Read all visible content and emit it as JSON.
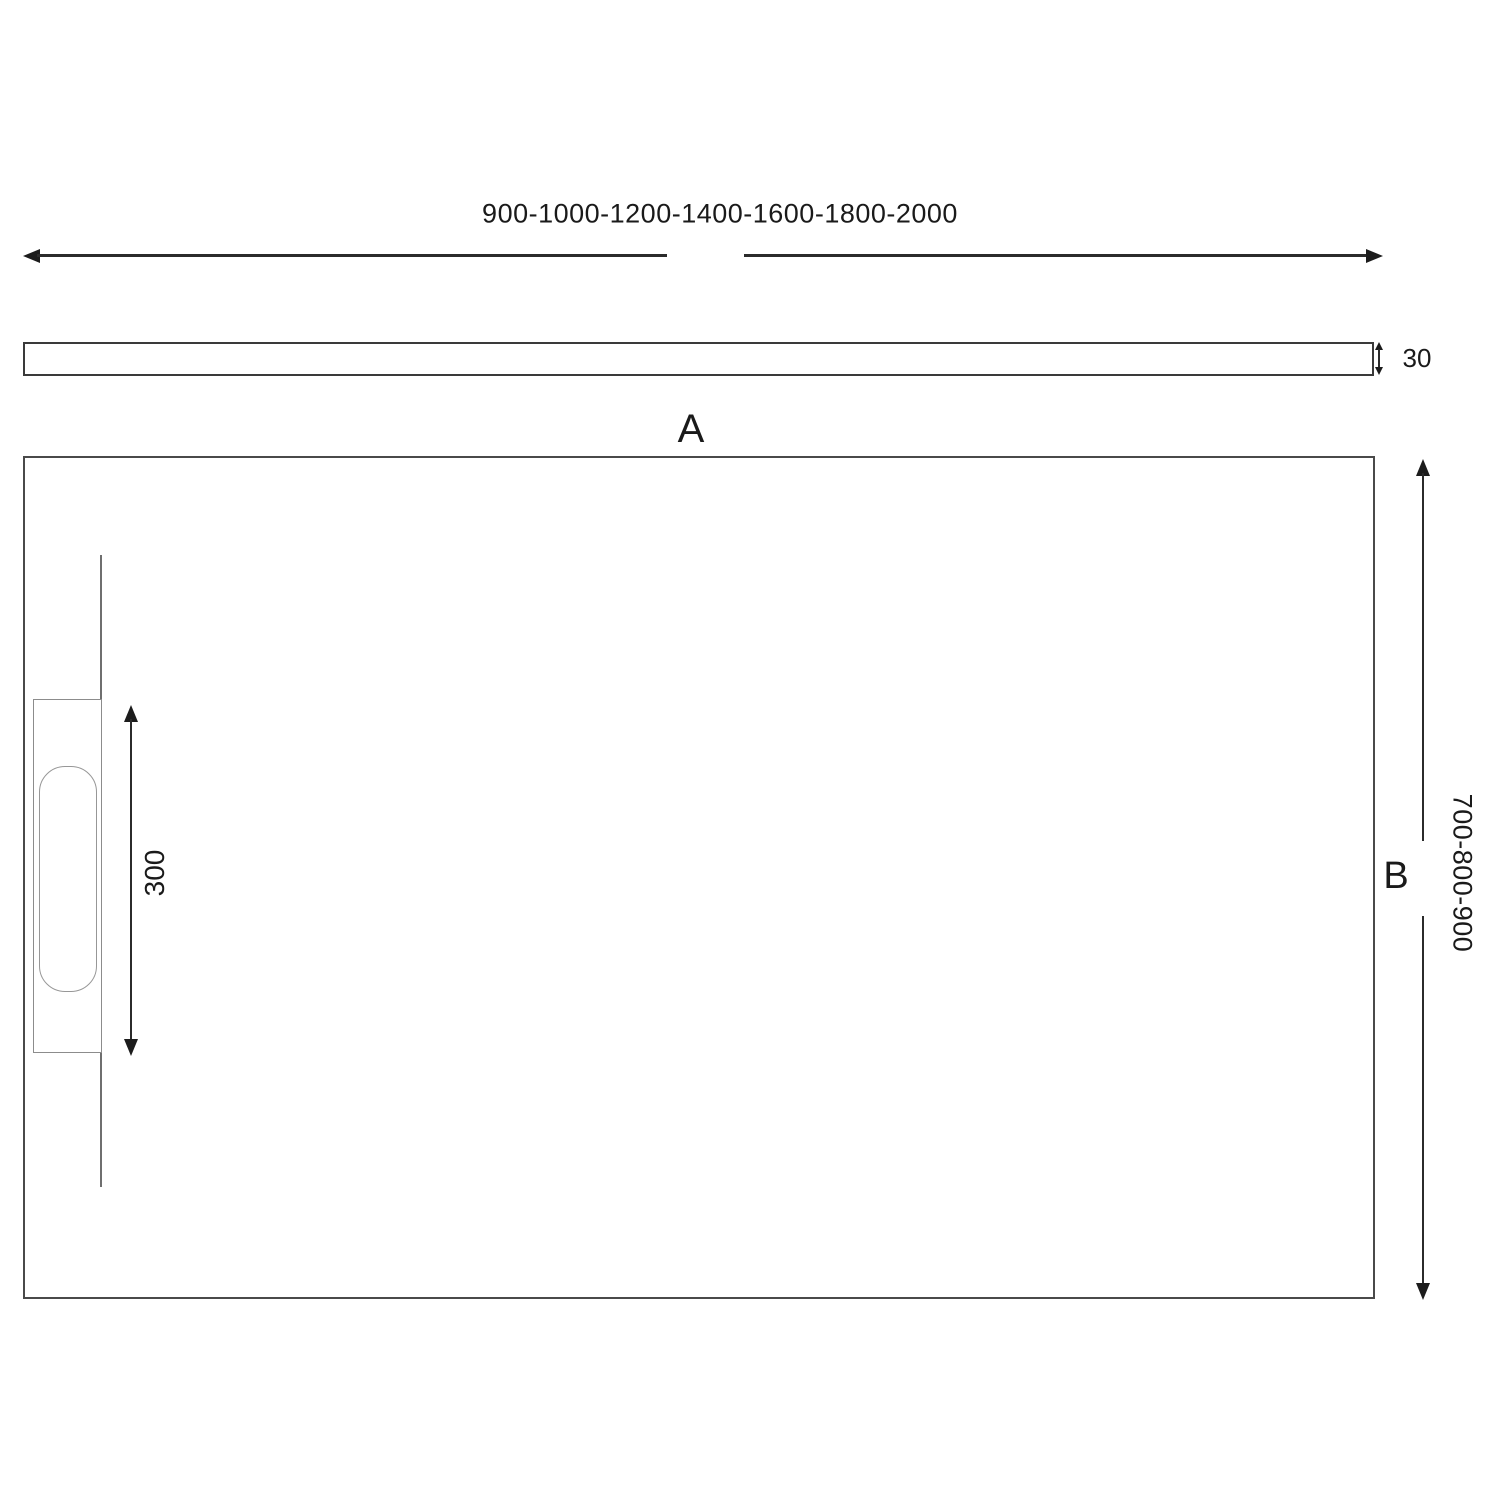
{
  "drawing": {
    "title_hint": "shower tray dimension drawing",
    "width_options_label": "900-1000-1200-1400-1600-1800-2000",
    "thickness_label": "30",
    "width_letter_label": "A",
    "depth_letter_label": "B",
    "drain_length_label": "300",
    "depth_options_label": "700-800-900"
  },
  "colors": {
    "background": "#ffffff",
    "line": "#2b2b2b",
    "arrowhead": "#1c1c1c",
    "outline_dark": "#3a3a3a",
    "outline_plan": "#4a4a4a",
    "outline_light": "#8c8c8c",
    "text": "#1a1a1a"
  }
}
